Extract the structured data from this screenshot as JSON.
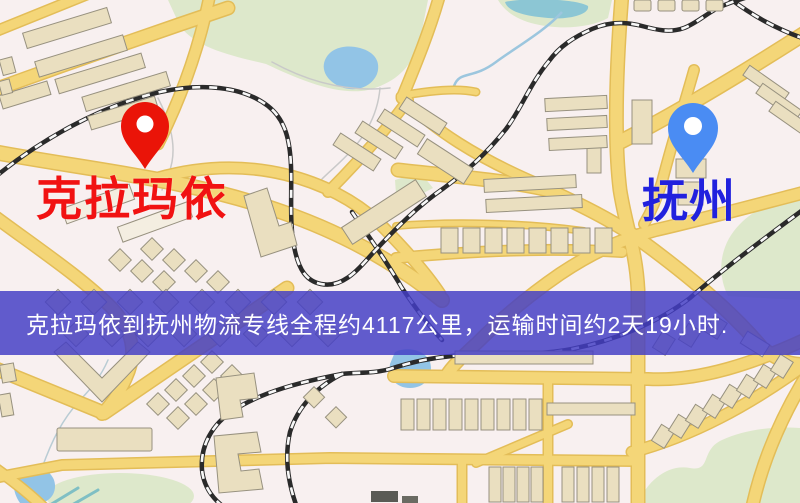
{
  "map": {
    "origin": {
      "label": "克拉玛依",
      "pin_color": "#ea1408",
      "label_color": "#f11212"
    },
    "destination": {
      "label": "抚州",
      "pin_color": "#4a8cf3",
      "label_color": "#2121de"
    },
    "banner": {
      "text": "克拉玛依到抚州物流专线全程约4117公里，运输时间约2天19小时.",
      "bg_rgba": "rgba(68,62,197,0.84)",
      "text_color": "#ffffff"
    },
    "route": {
      "distance_km": "4117",
      "duration": "2天19小时"
    },
    "colors": {
      "background": "#f8f0f0",
      "road": "#f4d678",
      "road_casing": "#e3bd58",
      "building": "#eadfc0",
      "park": "#dde8cb",
      "water": "#92c4e6",
      "railway": "#2a2a2a"
    }
  }
}
